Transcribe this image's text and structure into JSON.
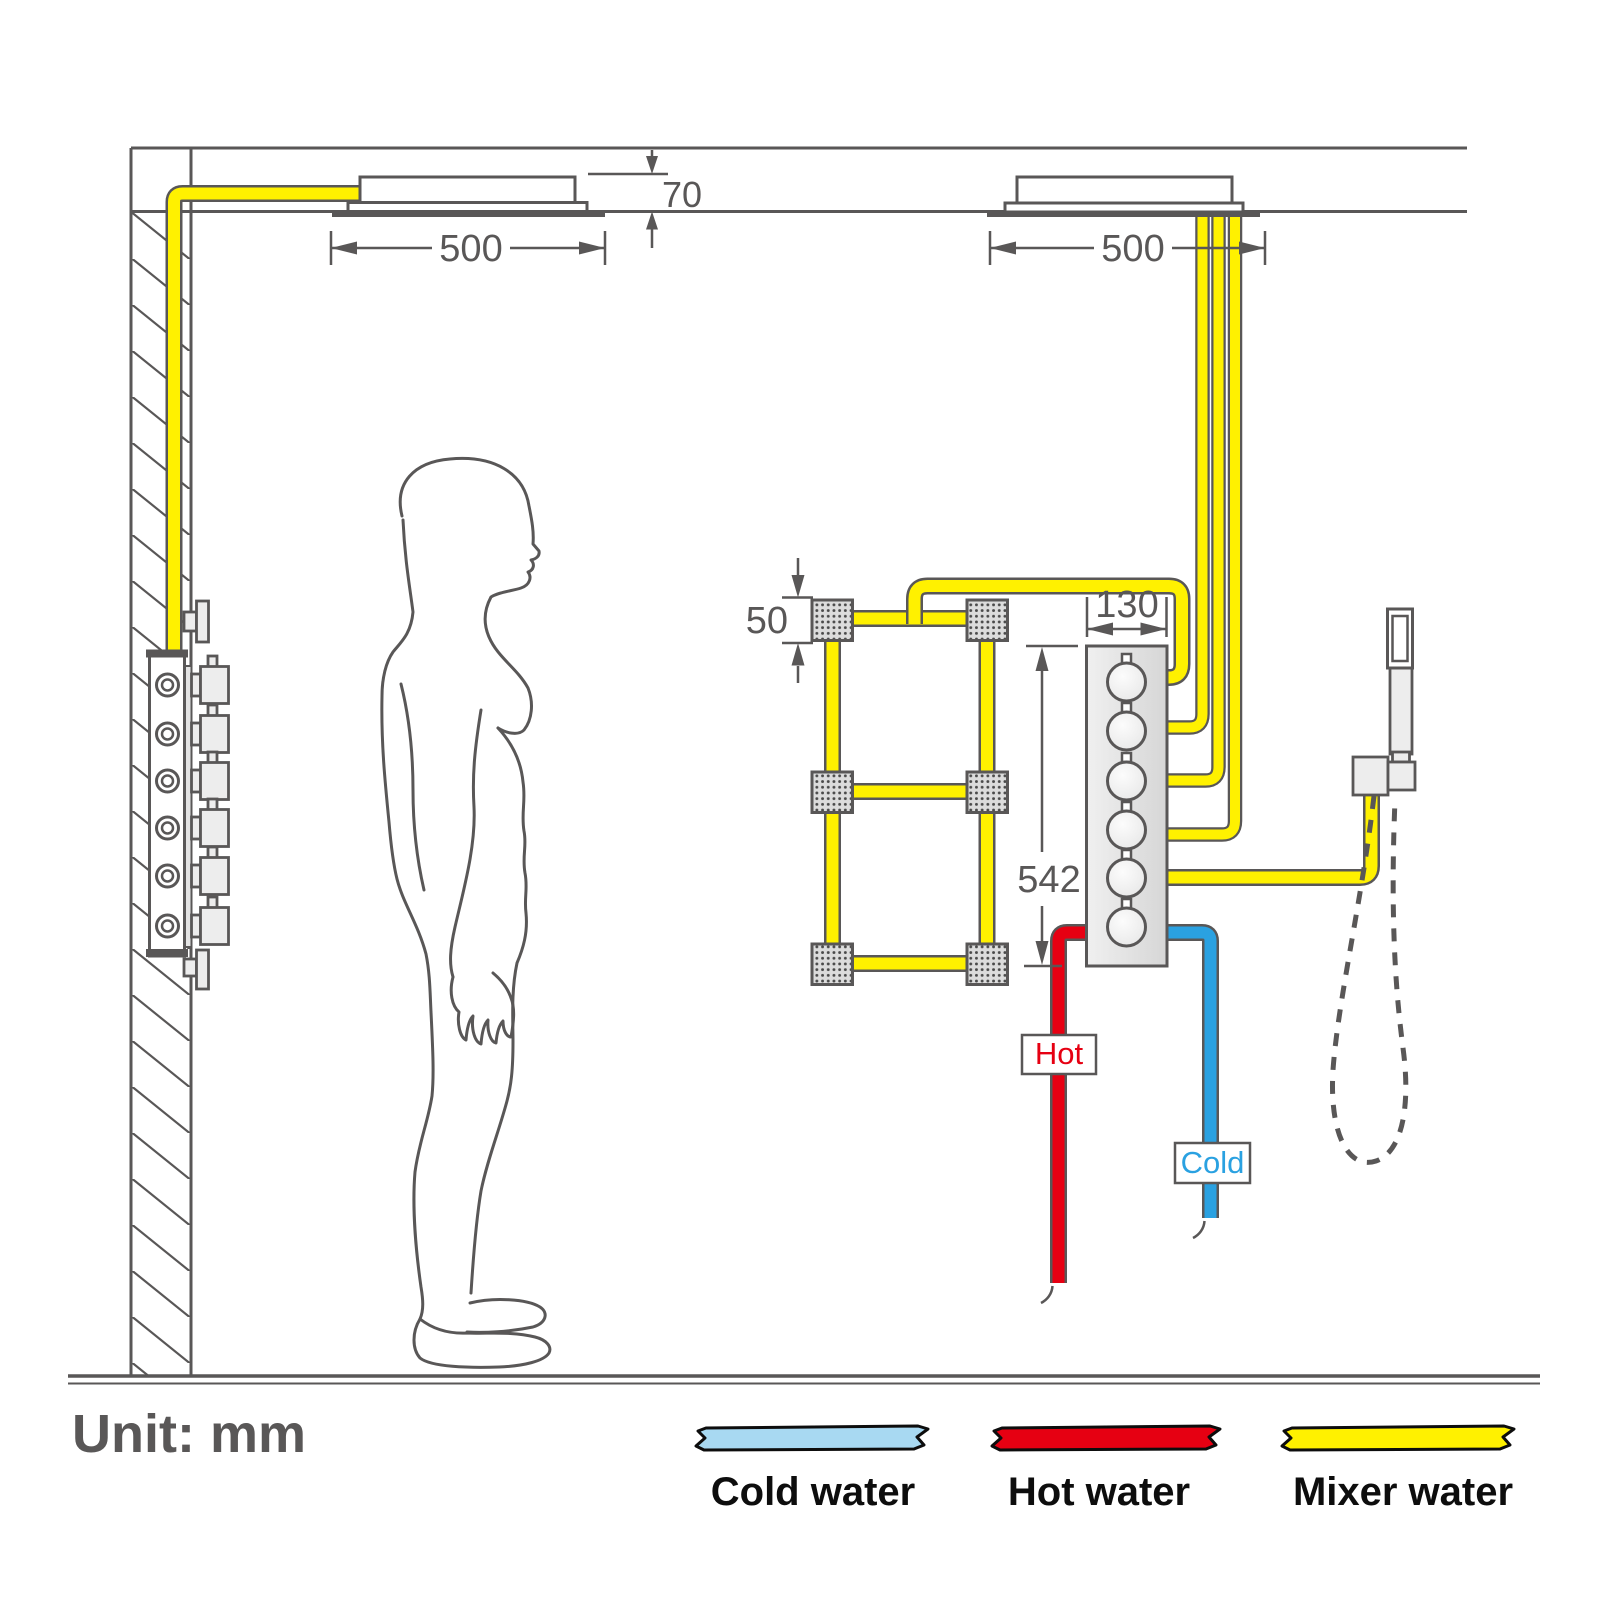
{
  "diagram": {
    "unit": "Unit: mm",
    "dims": {
      "head_left_width": "500",
      "head_recess_height": "70",
      "head_right_width": "500",
      "body_jet_size": "50",
      "valve_width": "130",
      "valve_height": "542"
    },
    "labels": {
      "hot": "Hot",
      "cold": "Cold"
    },
    "legend": {
      "items": [
        {
          "label": "Cold water",
          "color": "#A8D9F2"
        },
        {
          "label": "Hot water",
          "color": "#E60012"
        },
        {
          "label": "Mixer water",
          "color": "#FFF100"
        }
      ]
    },
    "colors": {
      "mixer_pipe": "#FFF100",
      "hot_pipe": "#E60012",
      "cold_pipe": "#2AA1E1",
      "line": "#595757"
    }
  }
}
